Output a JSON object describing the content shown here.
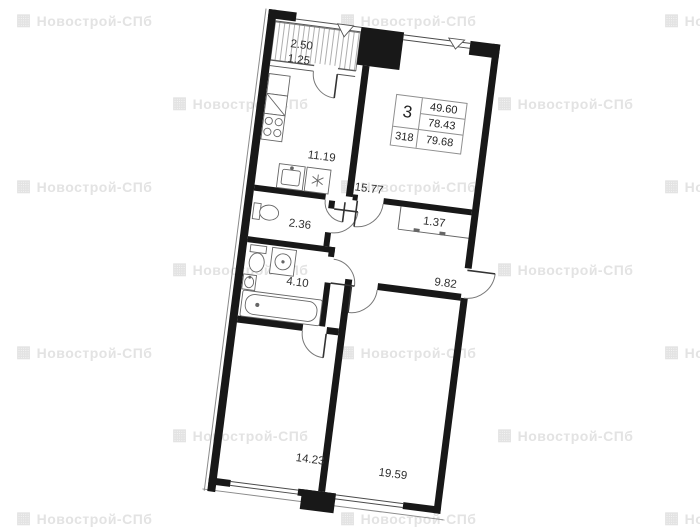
{
  "unit_card": {
    "rooms_count": "3",
    "living_area": "49.60",
    "area_without_balcony": "78.43",
    "unit_number": "318",
    "total_area": "79.68"
  },
  "balcony": {
    "area_full": "2.50",
    "area_reduced": "1.25"
  },
  "rooms": {
    "kitchen": "11.19",
    "living": "15.77",
    "wardrobe": "1.37",
    "wc": "2.36",
    "bathroom": "4.10",
    "hallway": "9.82",
    "bedroom_left": "14.23",
    "bedroom_right": "19.59"
  },
  "watermark": {
    "text": "Новострой-СПб",
    "icon": "▦",
    "color": "#e3e3e3",
    "positions": [
      [
        16,
        13
      ],
      [
        340,
        13
      ],
      [
        664,
        13
      ],
      [
        172,
        96
      ],
      [
        497,
        96
      ],
      [
        16,
        179
      ],
      [
        340,
        179
      ],
      [
        664,
        179
      ],
      [
        172,
        262
      ],
      [
        497,
        262
      ],
      [
        16,
        345
      ],
      [
        340,
        345
      ],
      [
        664,
        345
      ],
      [
        172,
        428
      ],
      [
        497,
        428
      ],
      [
        16,
        511
      ],
      [
        340,
        511
      ],
      [
        664,
        511
      ]
    ]
  },
  "colors": {
    "wall": "#181818",
    "line": "#555555",
    "label": "#303030"
  }
}
